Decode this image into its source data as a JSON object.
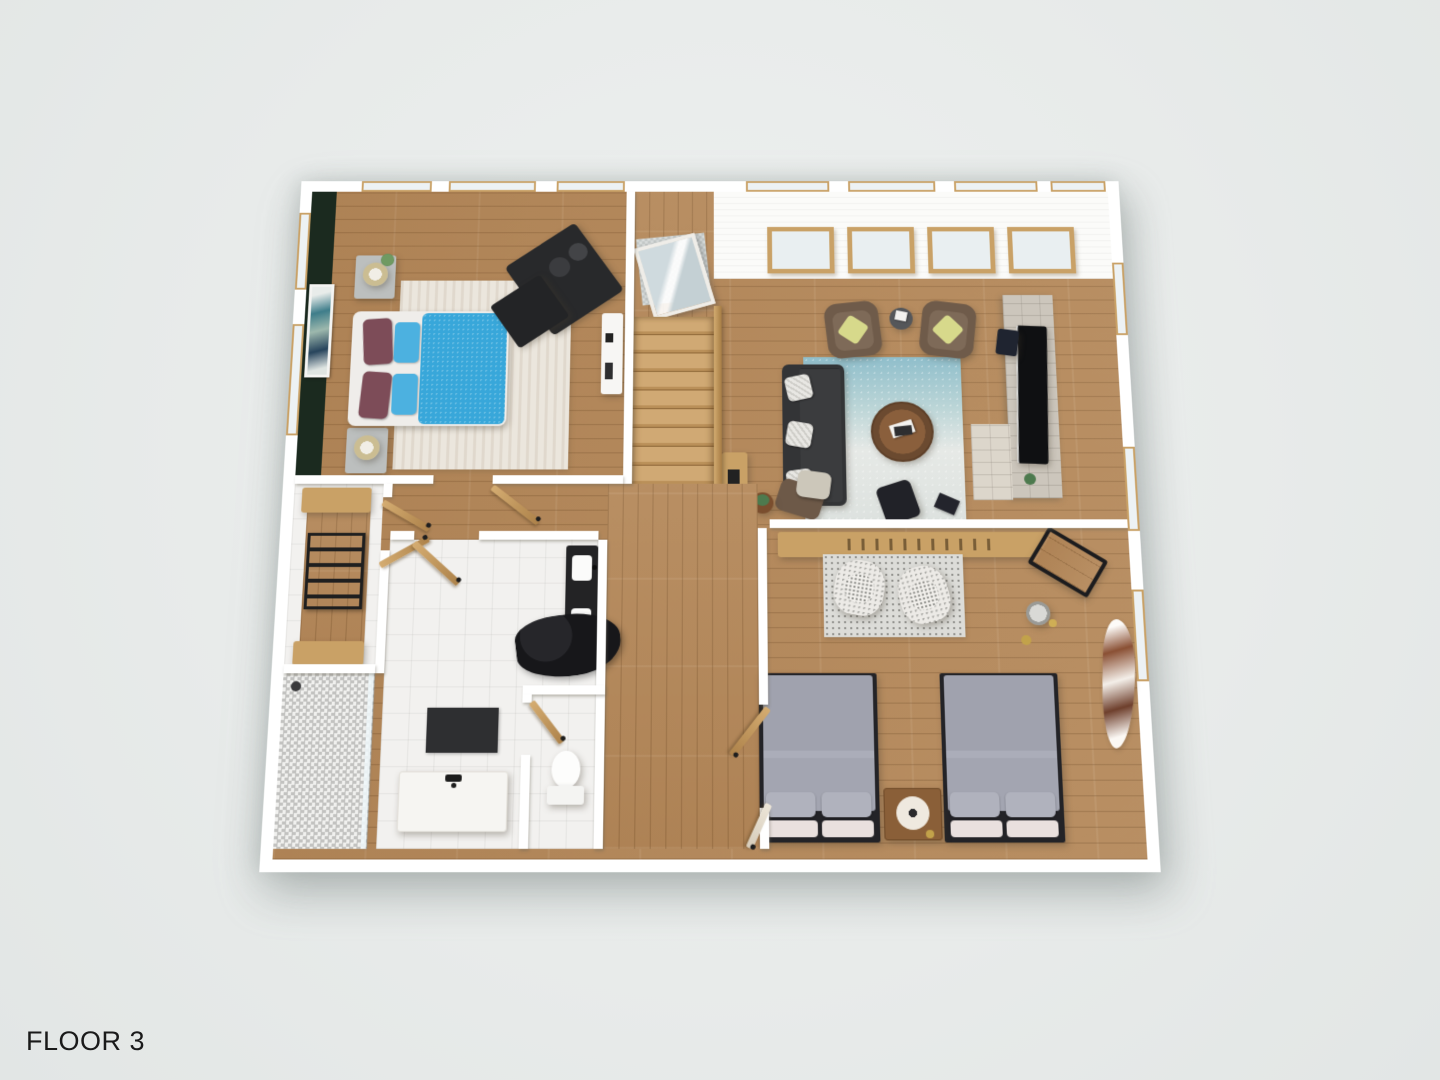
{
  "floor_label": {
    "text": "FLOOR 3"
  },
  "colors": {
    "bg": "#e8ebea",
    "wall": "#ffffff",
    "wood": "#b4885a",
    "wood_furn": "#c9a166",
    "tile": "#f2f1ef",
    "stone": "#ccc6bc",
    "green_wall": "#1b2a1f",
    "blue_duvet": "#38a7da",
    "blue_pillow": "#4cb1e0",
    "maroon_pillow": "#7d4c58",
    "charcoal": "#2b2c2e",
    "sofa": "#333436",
    "brown_chair": "#6f5b4a",
    "green_pillow": "#d7d98b",
    "rug_master": "#ebe6dd",
    "rug_living_a": "#8fbecb",
    "rug_living_b": "#e6e9e6",
    "gray_bed": "#a0a2ae",
    "gray_pillow": "#b0b2bd",
    "pink_pillow": "#e9e0de",
    "concrete": "#bcbfbe",
    "fur": "#17171a",
    "label": "#1a1a1a"
  }
}
